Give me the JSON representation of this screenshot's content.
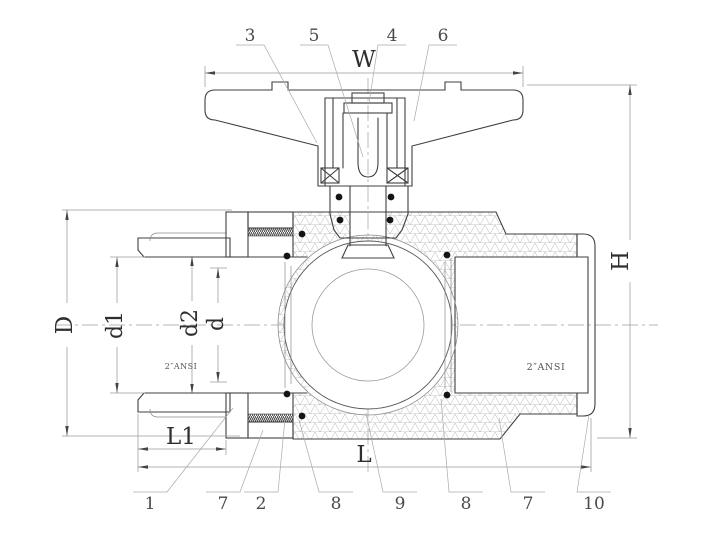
{
  "drawing": {
    "title": "ball-valve-cross-section",
    "dims": {
      "W": "W",
      "H": "H",
      "D": "D",
      "d1": "d1",
      "d2": "d2",
      "d": "d",
      "L1": "L1",
      "L": "L"
    },
    "parts_top": [
      "3",
      "5",
      "4",
      "6"
    ],
    "parts_bottom": [
      "1",
      "7",
      "2",
      "8",
      "9",
      "8",
      "7",
      "10"
    ],
    "ports": {
      "left": "2″ANSI",
      "right": "2″ANSI"
    },
    "colors": {
      "outline": "#3f3f3f",
      "dim_line": "#9a9a9a",
      "hatch": "#8a8a8a",
      "body_hatch": "#b5b5b5",
      "oring": "#141414",
      "background": "#ffffff"
    }
  }
}
